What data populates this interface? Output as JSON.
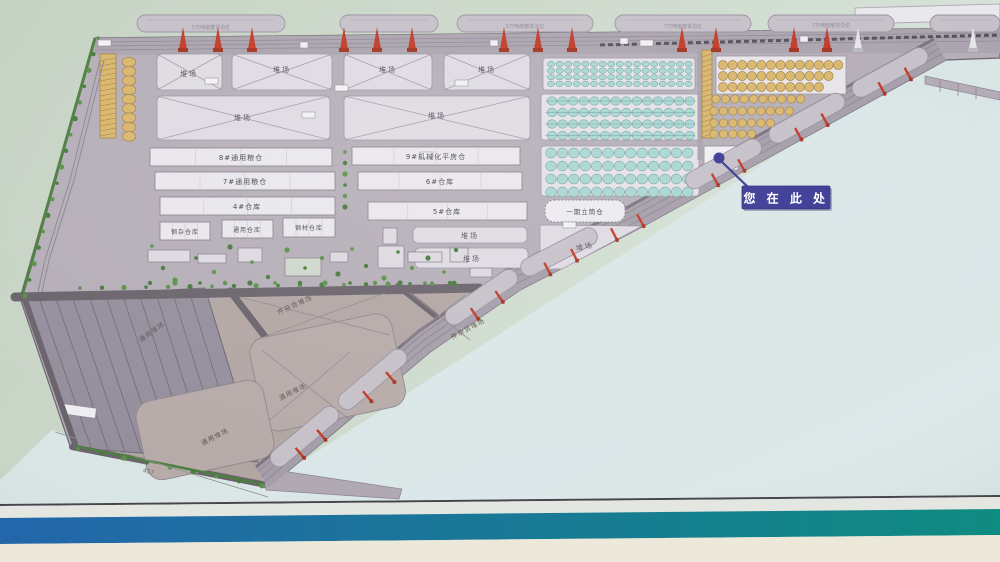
{
  "colors": {
    "sign_green": "#c7d4c5",
    "sign_green_right": "#d8e3db",
    "water": "#d8e3e4",
    "land": "#b5aeb8",
    "quay": "#aba4af",
    "parcel_light": "#dedbe2",
    "building": "#e9e7ec",
    "lower_land": "#b2a6a3",
    "road_dark": "#6a636c",
    "tank_teal": "#a9d6d2",
    "tank_gold": "#d8b66d",
    "crane_red": "#c23a28",
    "crane_white": "#e6e6e9",
    "tree_green": "#477a3c",
    "marker_blue": "#3a3a94",
    "ship_gray": "#c6c1c9",
    "band_white": "#e4e6e2",
    "band_blue": "#2366ab",
    "band_teal": "#0f8b81",
    "band_cream": "#ece8da",
    "band_line": "#45454b"
  },
  "marker": {
    "label": "您 在 此 处"
  },
  "labels": {
    "yard": "堆场",
    "w8": "8#通用粮仓",
    "w9": "9#机械化平房仓",
    "w7": "7#通用粮仓",
    "w6": "6#仓库",
    "w4": "4#仓库",
    "w5": "5#仓库",
    "steel_misc": "钢杂仓库",
    "general_wh": "通用仓库",
    "steel_wh": "钢材仓库",
    "silo": "一期立筒仓",
    "general_yard": "通用堆场",
    "breakbulk_yard": "件杂货堆场",
    "dim": "457"
  },
  "berths": {
    "b5": "5万吨级散货泊位",
    "b7": "7万吨级散货泊位"
  }
}
